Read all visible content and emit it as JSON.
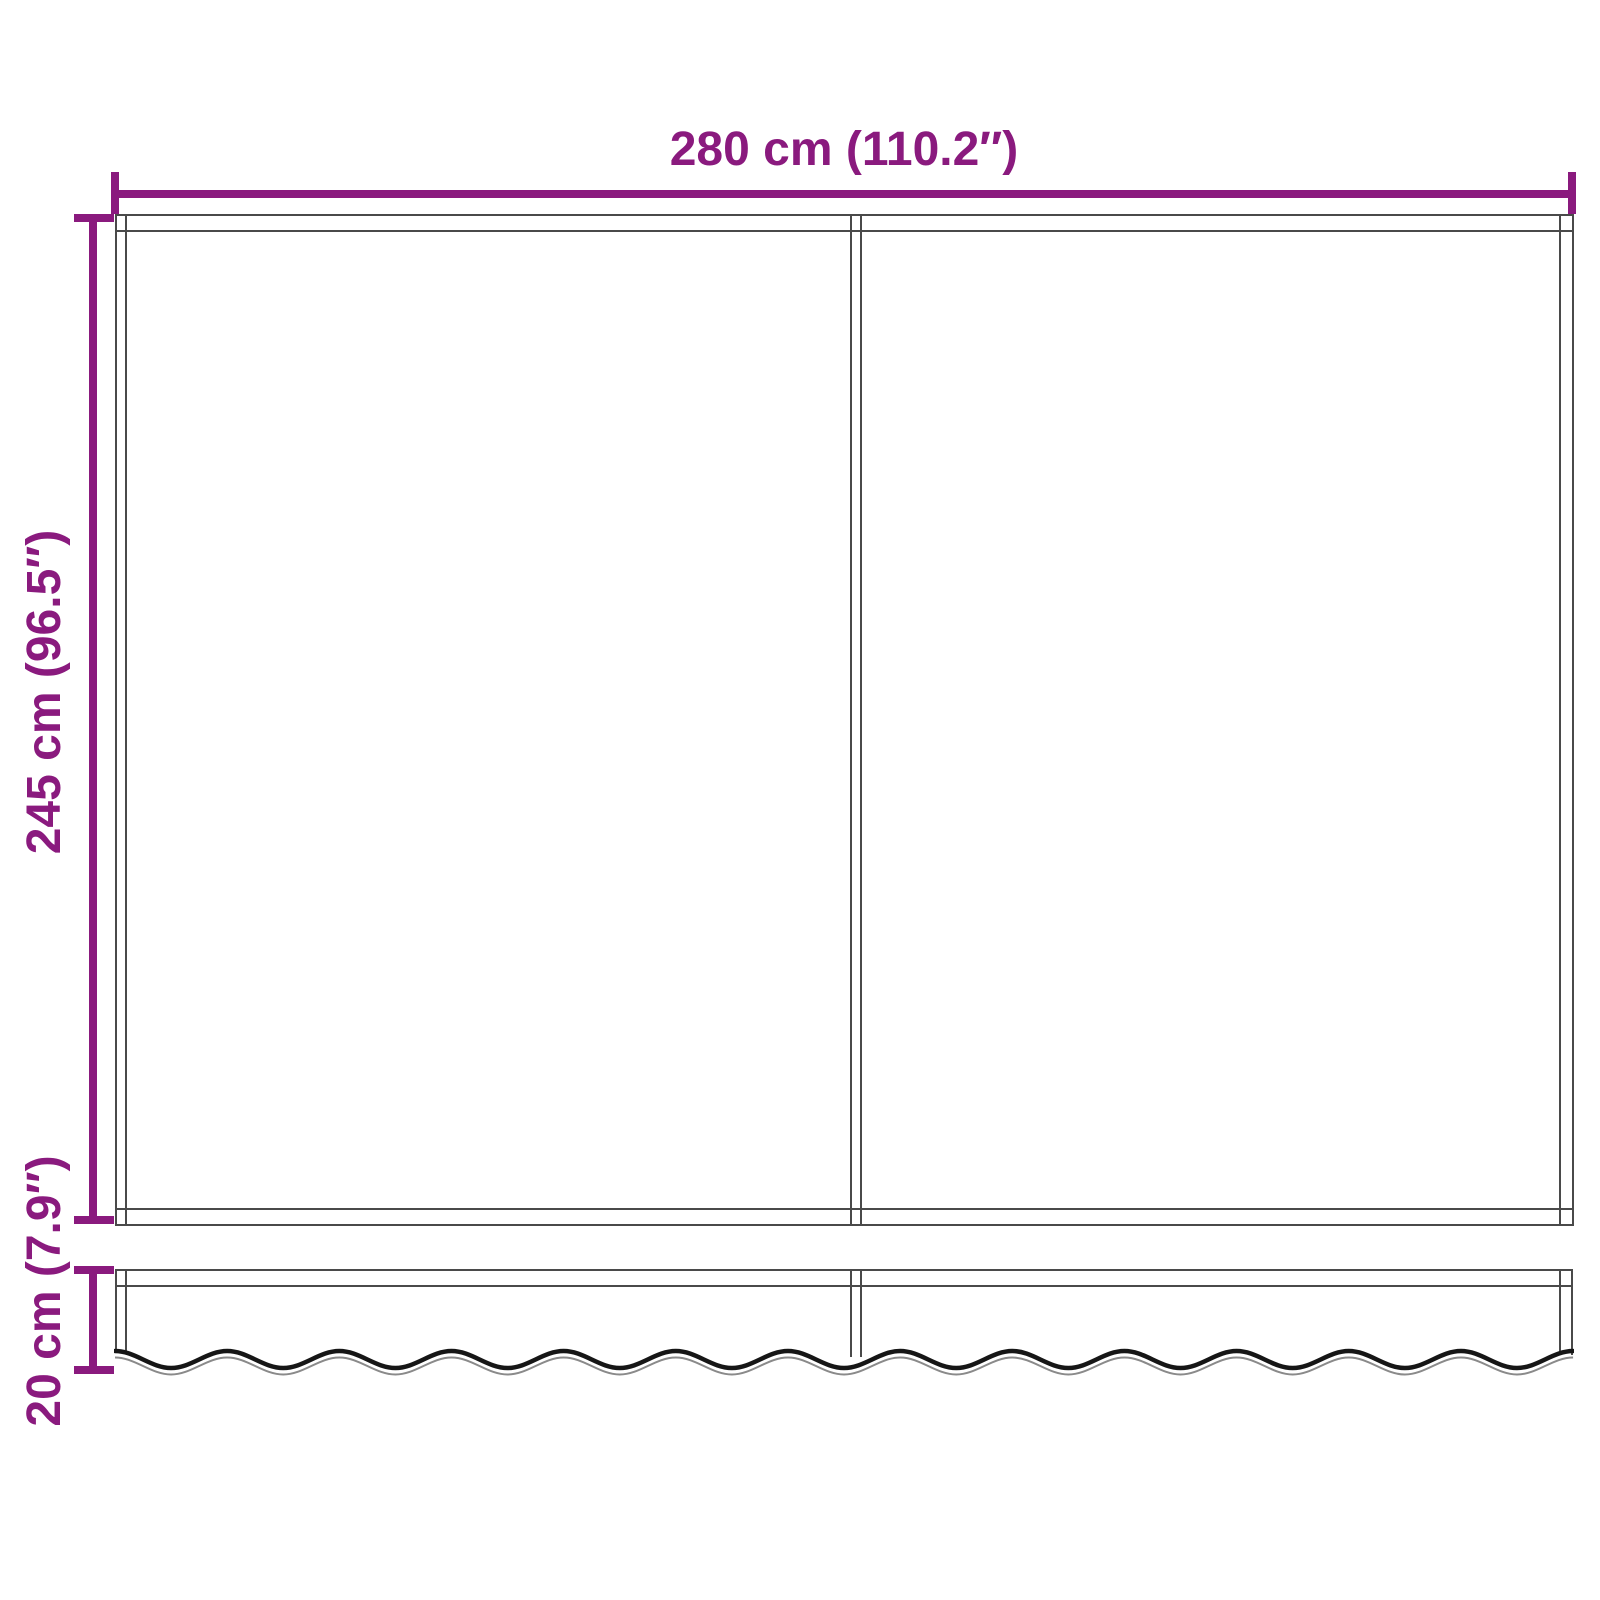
{
  "colors": {
    "accent": "#8A1A7E",
    "line": "#4A4A4A",
    "wave": "#161616",
    "wave2": "#8A8A8A",
    "background": "#FFFFFF"
  },
  "dimensions": {
    "width": {
      "label": "280 cm (110.2″)"
    },
    "height": {
      "label": "245 cm (96.5″)"
    },
    "valance_height": {
      "label": "20 cm (7.9″)"
    }
  }
}
